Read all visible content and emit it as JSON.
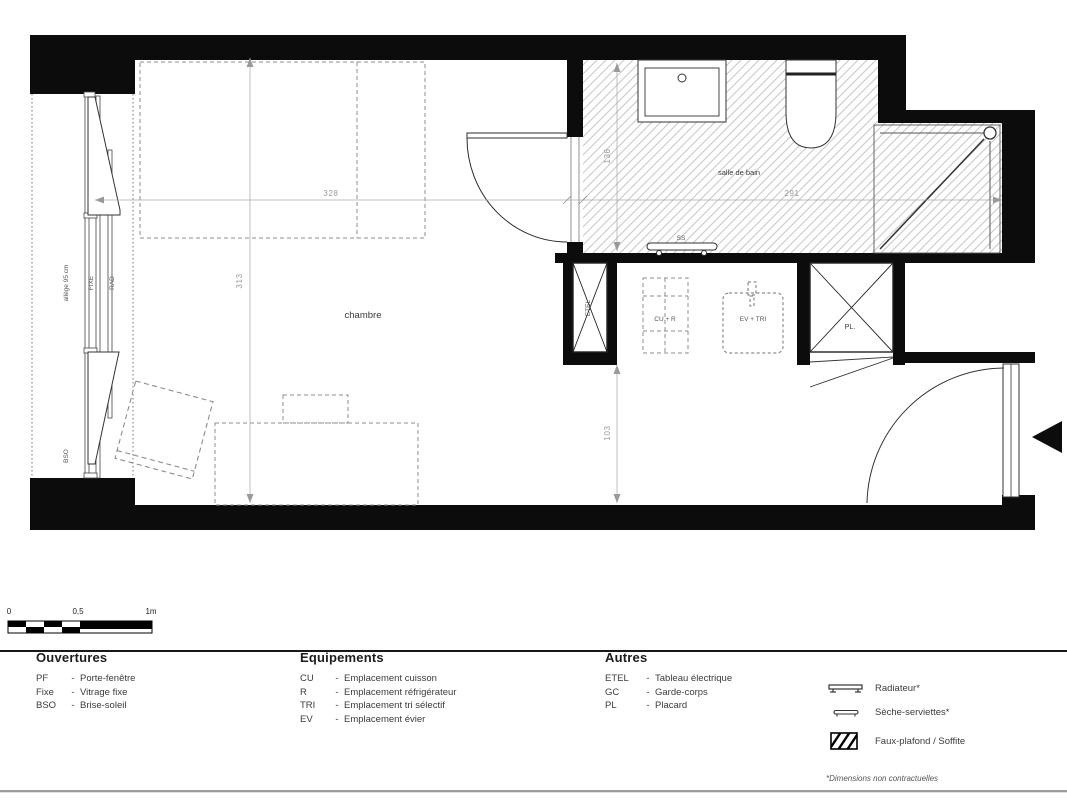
{
  "plan": {
    "rooms": {
      "chambre": "chambre",
      "salle_de_bain": "salle de bain"
    },
    "equipment": {
      "etel": "ETEL",
      "cu_r": "CU + R",
      "ev_tri": "EV + TRI",
      "pl": "PL.",
      "ss": "SS"
    },
    "window": {
      "allege": "allège 95 cm",
      "fixe": "FIXE",
      "rad": "RAD",
      "bso": "BSO"
    },
    "dimensions": {
      "chambre_width": "328",
      "chambre_depth": "313",
      "bath_width": "291",
      "bath_depth": "136",
      "hall_depth": "103"
    }
  },
  "scale_bar": {
    "zero": "0",
    "half": "0,5",
    "one": "1m"
  },
  "legend": {
    "columns": [
      {
        "title": "Ouvertures",
        "items": [
          {
            "abbr": "PF",
            "sep": "-",
            "label": "Porte-fenêtre"
          },
          {
            "abbr": "Fixe",
            "sep": "-",
            "label": "Vitrage fixe"
          },
          {
            "abbr": "BSO",
            "sep": "-",
            "label": "Brise-soleil"
          }
        ]
      },
      {
        "title": "Equipements",
        "items": [
          {
            "abbr": "CU",
            "sep": "-",
            "label": "Emplacement cuisson"
          },
          {
            "abbr": "R",
            "sep": "-",
            "label": "Emplacement réfrigérateur"
          },
          {
            "abbr": "TRI",
            "sep": "-",
            "label": "Emplacement tri sélectif"
          },
          {
            "abbr": "EV",
            "sep": "-",
            "label": "Emplacement évier"
          }
        ]
      },
      {
        "title": "Autres",
        "items": [
          {
            "abbr": "ETEL",
            "sep": "-",
            "label": "Tableau électrique"
          },
          {
            "abbr": "GC",
            "sep": "-",
            "label": "Garde-corps"
          },
          {
            "abbr": "PL",
            "sep": "-",
            "label": "Placard"
          }
        ]
      }
    ],
    "symbols": [
      {
        "label": "Radiateur*"
      },
      {
        "label": "Sèche-serviettes*"
      },
      {
        "label": "Faux-plafond / Soffite"
      }
    ],
    "footnote": "*Dimensions non contractuelles"
  }
}
